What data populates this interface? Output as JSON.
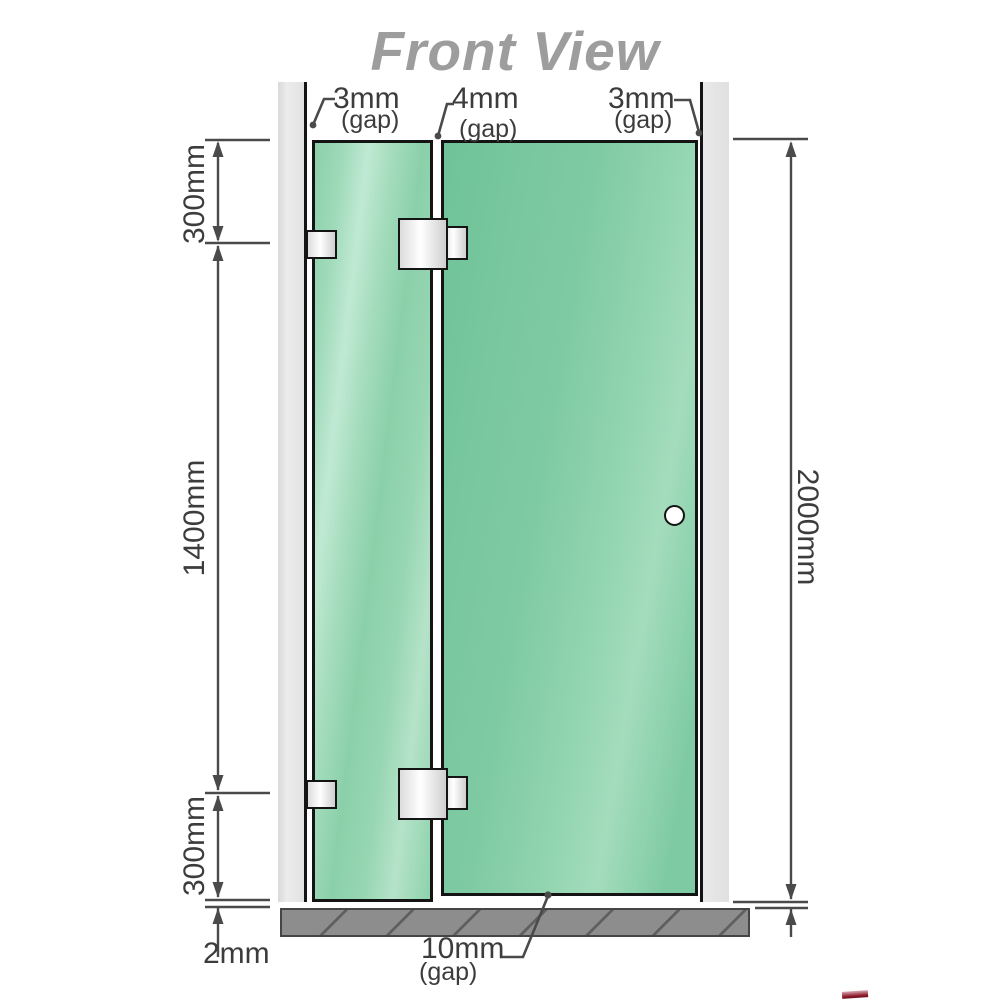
{
  "title": "Front View",
  "annotations": {
    "gap_top_left": {
      "value": "3mm",
      "suffix": "(gap)"
    },
    "gap_top_middle": {
      "value": "4mm",
      "suffix": "(gap)"
    },
    "gap_top_right": {
      "value": "3mm",
      "suffix": "(gap)"
    },
    "gap_bottom": {
      "value": "10mm",
      "suffix": "(gap)"
    },
    "bottom_clearance": "2mm"
  },
  "dimensions": {
    "left_top_segment": "300mm",
    "left_middle_segment": "1400mm",
    "left_bottom_segment": "300mm",
    "overall_height": "2000mm"
  },
  "colors": {
    "glass_green": "#7ecaa3",
    "glass_highlight": "#c0e9d3",
    "wall_channel": "#e6e6e6",
    "floor_gray": "#8d8d8d",
    "outline_black": "#141414",
    "dimension_gray": "#4a4a4a",
    "title_gray": "#9d9d9d"
  }
}
